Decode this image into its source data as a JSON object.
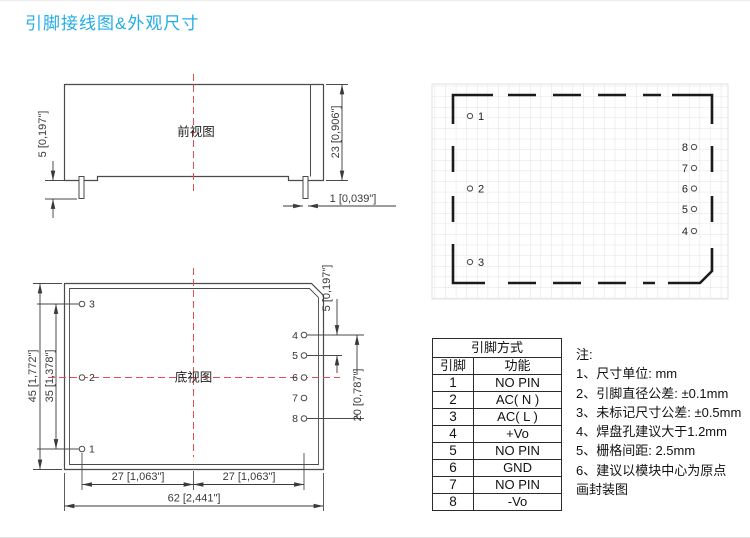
{
  "page": {
    "title": "引脚接线图&外观尺寸",
    "accent_color": "#23ADE5",
    "line_color": "#4a4a4a",
    "centerline_color": "#E34D4D",
    "grid_color": "#E2E2E2"
  },
  "front_view": {
    "label": "前视图",
    "dims": {
      "pin_length": "5 [0,197\"]",
      "body_height": "23 [0,906\"]",
      "pin_diameter": "1 [0,039\"]"
    }
  },
  "bottom_view": {
    "label": "底视图",
    "left_pins": [
      "3",
      "2",
      "1"
    ],
    "right_pins": [
      "4",
      "5",
      "6",
      "7",
      "8"
    ],
    "dims": {
      "body_height": "45 [1,772\"]",
      "left_pin_span": "35 [1,378\"]",
      "right_pin_pitch": "5 [0,197\"]",
      "right_pin_span": "20 [0,787\"]",
      "half_width_left": "27 [1,063\"]",
      "half_width_right": "27 [1,063\"]",
      "body_width": "62 [2,441\"]"
    }
  },
  "footprint": {
    "left_pins": [
      "1",
      "2",
      "3"
    ],
    "right_pins": [
      "8",
      "7",
      "6",
      "5",
      "4"
    ]
  },
  "pin_table": {
    "title": "引脚方式",
    "headers": [
      "引脚",
      "功能"
    ],
    "rows": [
      [
        "1",
        "NO PIN"
      ],
      [
        "2",
        "AC( N )"
      ],
      [
        "3",
        "AC( L )"
      ],
      [
        "4",
        "+Vo"
      ],
      [
        "5",
        "NO PIN"
      ],
      [
        "6",
        "GND"
      ],
      [
        "7",
        "NO PIN"
      ],
      [
        "8",
        "-Vo"
      ]
    ]
  },
  "notes": {
    "title": "注:",
    "items": [
      "1、尺寸单位: mm",
      "2、引脚直径公差: ±0.1mm",
      "3、未标记尺寸公差: ±0.5mm",
      "4、焊盘孔建议大于1.2mm",
      "5、栅格间距: 2.5mm",
      "6、建议以模块中心为原点",
      "画封装图"
    ]
  }
}
